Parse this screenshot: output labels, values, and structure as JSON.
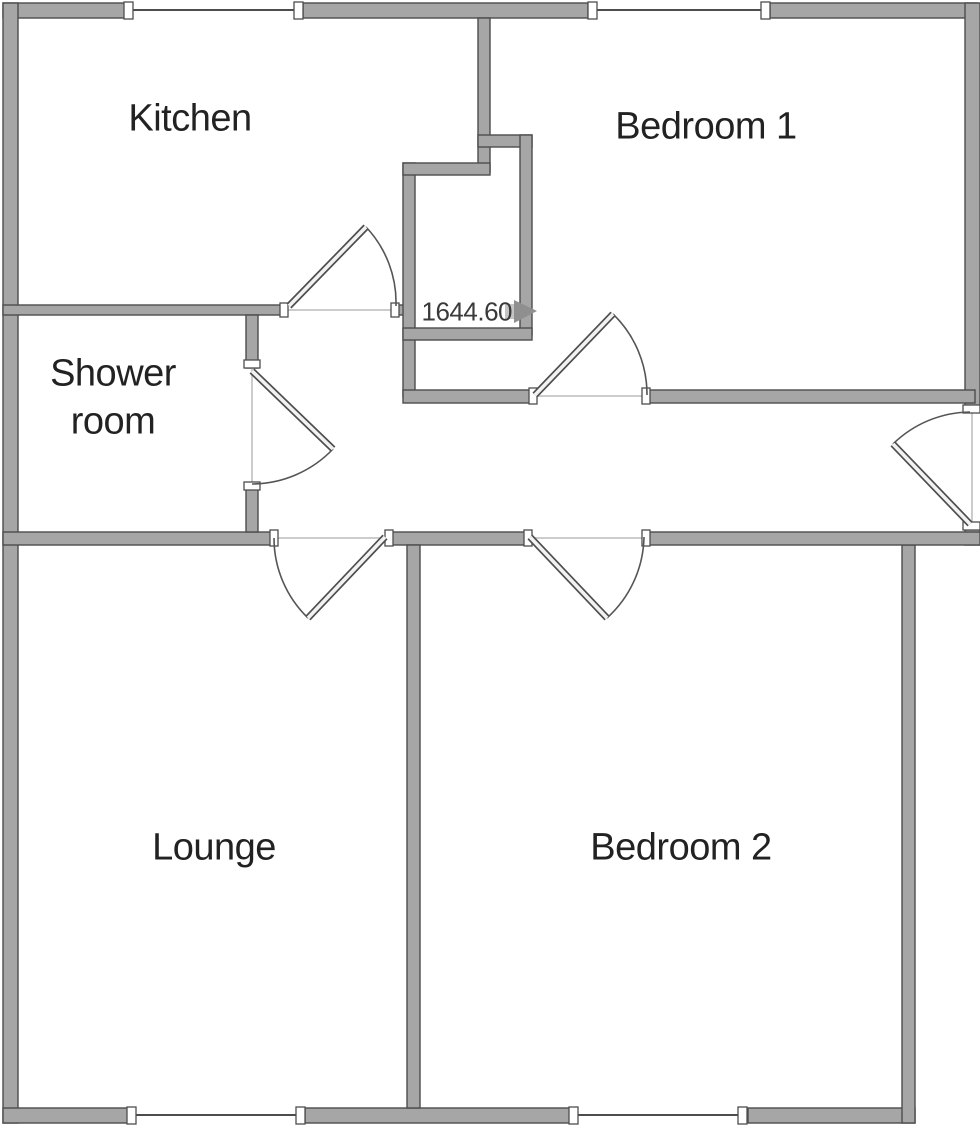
{
  "floorplan": {
    "labels": {
      "kitchen": "Kitchen",
      "bedroom1": "Bedroom 1",
      "shower_line1": "Shower",
      "shower_line2": "room",
      "lounge": "Lounge",
      "bedroom2": "Bedroom 2"
    },
    "measurement": {
      "value": "1644.60"
    },
    "colors": {
      "wall_fill": "#a6a6a6",
      "wall_outline": "#4d4d4d",
      "door_line": "#555555",
      "ghost_line": "#cccccc",
      "text": "#222222",
      "measurement_text": "#3a3a3a",
      "arrow": "#8f8f8f",
      "background": "#ffffff"
    }
  }
}
